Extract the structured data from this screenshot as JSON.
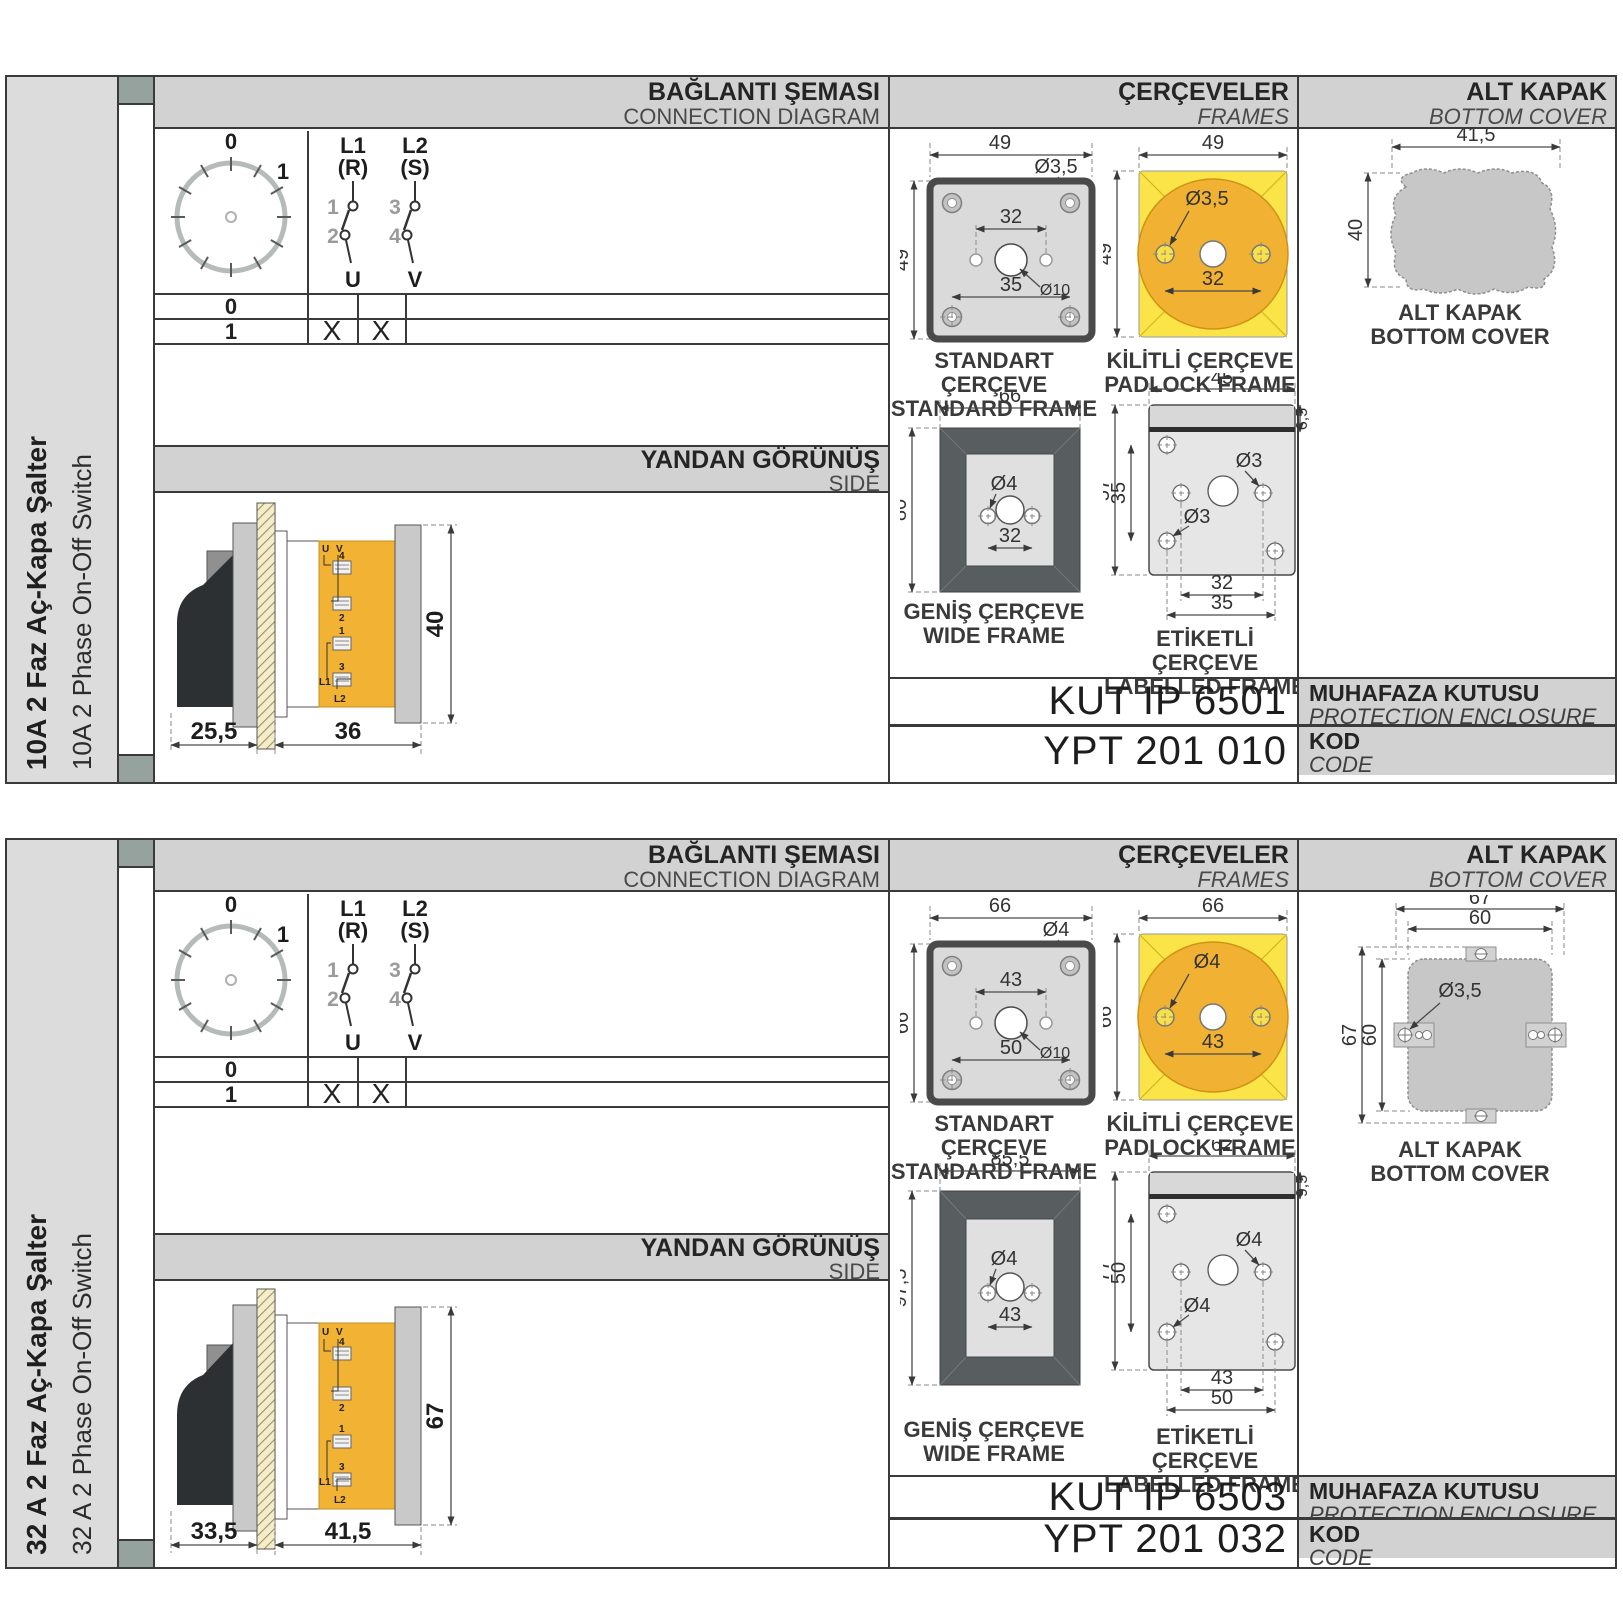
{
  "colors": {
    "border": "#3a3a3a",
    "band_gray": "#d2d2d2",
    "sidebar_gray": "#dcdcdc",
    "tab_square": "#96a29e",
    "frame_yellow": "#fbe448",
    "frame_orange": "#f1b233",
    "wide_frame_dark": "#585d60",
    "cover_gray": "#c7c7c7"
  },
  "sections": [
    {
      "sidebar": {
        "title_tr": "10A 2 Faz Aç-Kapa Şalter",
        "title_en": "10A 2 Phase On-Off Switch"
      },
      "headers": {
        "connection_tr": "BAĞLANTI ŞEMASI",
        "connection_en": "CONNECTION DIAGRAM",
        "frames_tr": "ÇERÇEVELER",
        "frames_en": "FRAMES",
        "cover_tr": "ALT KAPAK",
        "cover_en": "BOTTOM COVER",
        "side_tr": "YANDAN GÖRÜNÜŞ",
        "side_en": "SIDE"
      },
      "connection": {
        "dial0": "0",
        "dial1": "1",
        "l1": "L1",
        "r": "(R)",
        "l2": "L2",
        "s": "(S)",
        "n1": "1",
        "n2": "2",
        "n3": "3",
        "n4": "4",
        "u": "U",
        "v": "V",
        "row0": "0",
        "row1": "1",
        "x_u": "X",
        "x_v": "X"
      },
      "side_view": {
        "d_handle": "25,5",
        "d_body": "36",
        "d_height": "40",
        "labels": {
          "u": "U",
          "v": "V",
          "n4": "4",
          "n2": "2",
          "n1": "1",
          "n3": "3",
          "l1": "L1",
          "l2": "L2"
        }
      },
      "frames": {
        "standard": {
          "cap_tr": "STANDART ÇERÇEVE",
          "cap_en": "STANDARD FRAME",
          "w": "49",
          "h": "49",
          "hole": "Ø3,5",
          "inner": "32",
          "outer": "35",
          "center": "Ø10"
        },
        "padlock": {
          "cap_tr": "KİLİTLİ ÇERÇEVE",
          "cap_en": "PADLOCK FRAME",
          "w": "49",
          "h": "49",
          "hole": "Ø3,5",
          "inner": "32"
        },
        "wide": {
          "cap_tr": "GENİŞ ÇERÇEVE",
          "cap_en": "WIDE FRAME",
          "w": "66",
          "h": "80",
          "hole": "Ø4",
          "inner": "32"
        },
        "labelled": {
          "cap_tr": "ETİKETLİ ÇERÇEVE",
          "cap_en": "LABELLED FRAME",
          "w": "45",
          "tab": "6,5",
          "h": "57",
          "mid": "35",
          "hole1": "Ø3",
          "hole2": "Ø3",
          "inner": "32",
          "outer": "35"
        }
      },
      "cover": {
        "cap_tr": "ALT KAPAK",
        "cap_en": "BOTTOM COVER",
        "w": "41,5",
        "h": "40"
      },
      "codes": {
        "enclosure_value": "KUT IP 6501",
        "enclosure_tr": "MUHAFAZA KUTUSU",
        "enclosure_en": "PROTECTION ENCLOSURE",
        "code_value": "YPT 201 010",
        "code_tr": "KOD",
        "code_en": "CODE"
      }
    },
    {
      "sidebar": {
        "title_tr": "32 A 2 Faz Aç-Kapa Şalter",
        "title_en": "32 A 2 Phase On-Off Switch"
      },
      "headers": {
        "connection_tr": "BAĞLANTI ŞEMASI",
        "connection_en": "CONNECTION DIAGRAM",
        "frames_tr": "ÇERÇEVELER",
        "frames_en": "FRAMES",
        "cover_tr": "ALT KAPAK",
        "cover_en": "BOTTOM COVER",
        "side_tr": "YANDAN GÖRÜNÜŞ",
        "side_en": "SIDE"
      },
      "connection": {
        "dial0": "0",
        "dial1": "1",
        "l1": "L1",
        "r": "(R)",
        "l2": "L2",
        "s": "(S)",
        "n1": "1",
        "n2": "2",
        "n3": "3",
        "n4": "4",
        "u": "U",
        "v": "V",
        "row0": "0",
        "row1": "1",
        "x_u": "X",
        "x_v": "X"
      },
      "side_view": {
        "d_handle": "33,5",
        "d_body": "41,5",
        "d_height": "67",
        "labels": {
          "u": "U",
          "v": "V",
          "n4": "4",
          "n2": "2",
          "n1": "1",
          "n3": "3",
          "l1": "L1",
          "l2": "L2"
        }
      },
      "frames": {
        "standard": {
          "cap_tr": "STANDART ÇERÇEVE",
          "cap_en": "STANDARD FRAME",
          "w": "66",
          "h": "66",
          "hole": "Ø4",
          "inner": "43",
          "outer": "50",
          "center": "Ø10"
        },
        "padlock": {
          "cap_tr": "KİLİTLİ ÇERÇEVE",
          "cap_en": "PADLOCK FRAME",
          "w": "66",
          "h": "66",
          "hole": "Ø4",
          "inner": "43"
        },
        "wide": {
          "cap_tr": "GENİŞ ÇERÇEVE",
          "cap_en": "WIDE FRAME",
          "w": "85,5",
          "h": "97,5",
          "hole": "Ø4",
          "inner": "43"
        },
        "labelled": {
          "cap_tr": "ETİKETLİ ÇERÇEVE",
          "cap_en": "LABELLED FRAME",
          "w": "62",
          "tab": "9,5",
          "h": "77",
          "mid": "50",
          "hole1": "Ø4",
          "hole2": "Ø4",
          "inner": "43",
          "outer": "50"
        }
      },
      "cover": {
        "cap_tr": "ALT KAPAK",
        "cap_en": "BOTTOM COVER",
        "w1": "67",
        "w2": "60",
        "h1": "67",
        "h2": "60",
        "hole": "Ø3,5"
      },
      "codes": {
        "enclosure_value": "KUT IP 6503",
        "enclosure_tr": "MUHAFAZA KUTUSU",
        "enclosure_en": "PROTECTION ENCLOSURE",
        "code_value": "YPT 201 032",
        "code_tr": "KOD",
        "code_en": "CODE"
      }
    }
  ]
}
